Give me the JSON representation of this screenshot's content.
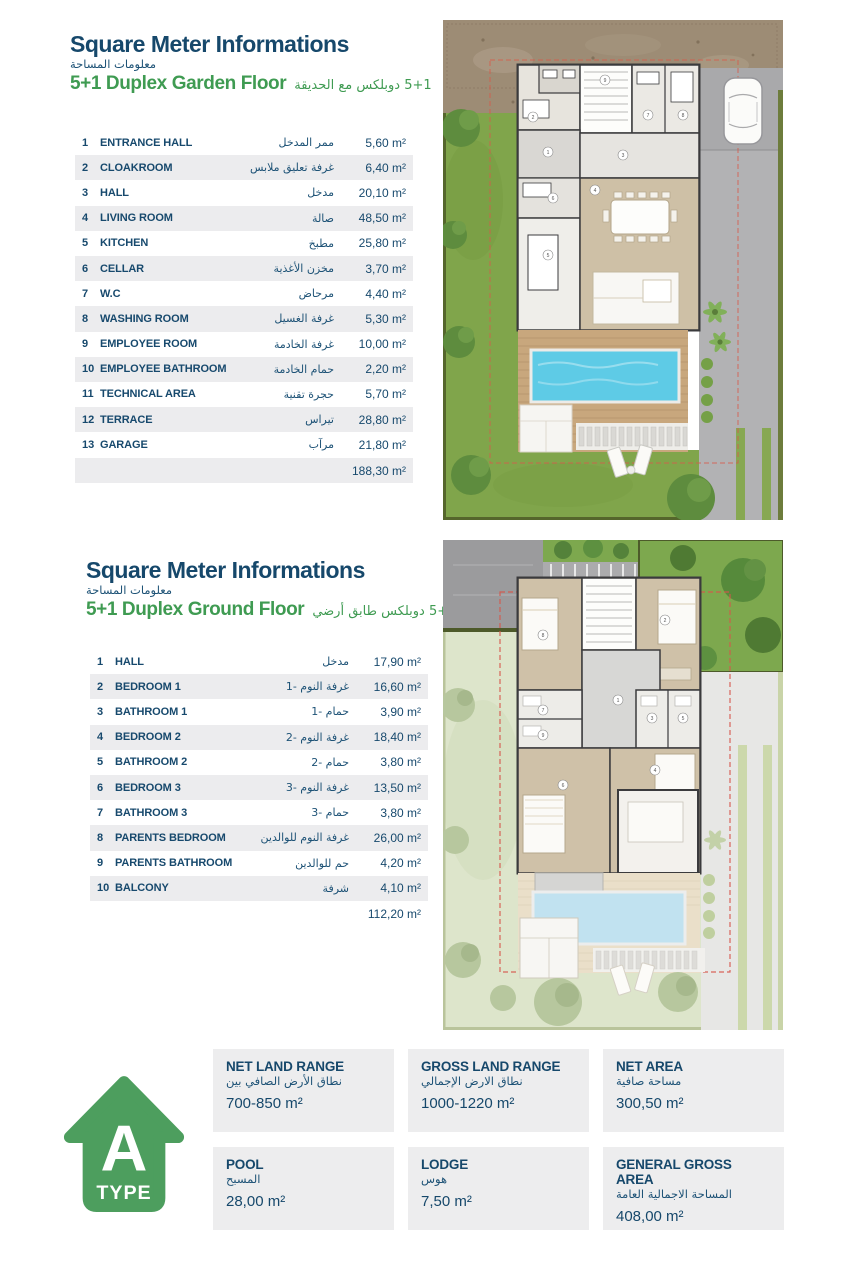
{
  "colors": {
    "navy": "#16486b",
    "green": "#3f9b52",
    "row_alt": "#ececee",
    "icon_green": "#4d9e5e",
    "pool_blue": "#5ecbe6",
    "lawn_green": "#80a54b"
  },
  "section1": {
    "title": "Square Meter Informations",
    "title_ar": "معلومات المساحة",
    "subtitle": "5+1 Duplex Garden Floor",
    "subtitle_ar": "5+1 دوبلكس مع الحديقة",
    "rows": [
      {
        "num": "1",
        "name": "ENTRANCE HALL",
        "ar": "ممر المدخل",
        "value": "5,60 m²"
      },
      {
        "num": "2",
        "name": "CLOAKROOM",
        "ar": "غرفة تعليق ملابس",
        "value": "6,40 m²"
      },
      {
        "num": "3",
        "name": "HALL",
        "ar": "مدخل",
        "value": "20,10 m²"
      },
      {
        "num": "4",
        "name": "LIVING ROOM",
        "ar": "صالة",
        "value": "48,50 m²"
      },
      {
        "num": "5",
        "name": "KITCHEN",
        "ar": "مطبخ",
        "value": "25,80 m²"
      },
      {
        "num": "6",
        "name": "CELLAR",
        "ar": "مخزن الأغذية",
        "value": "3,70 m²"
      },
      {
        "num": "7",
        "name": "W.C",
        "ar": "مرحاض",
        "value": "4,40 m²"
      },
      {
        "num": "8",
        "name": "WASHING ROOM",
        "ar": "غرفة الغسيل",
        "value": "5,30 m²"
      },
      {
        "num": "9",
        "name": "EMPLOYEE ROOM",
        "ar": "غرفة الخادمة",
        "value": "10,00 m²"
      },
      {
        "num": "10",
        "name": "EMPLOYEE BATHROOM",
        "ar": "حمام الخادمة",
        "value": "2,20 m²"
      },
      {
        "num": "11",
        "name": "TECHNICAL AREA",
        "ar": "حجرة تقنية",
        "value": "5,70 m²"
      },
      {
        "num": "12",
        "name": "TERRACE",
        "ar": "تيراس",
        "value": "28,80 m²"
      },
      {
        "num": "13",
        "name": "GARAGE",
        "ar": "مرآب",
        "value": "21,80 m²"
      }
    ],
    "total": "188,30 m²"
  },
  "section2": {
    "title": "Square Meter Informations",
    "title_ar": "معلومات المساحة",
    "subtitle": "5+1 Duplex Ground Floor",
    "subtitle_ar": "5+1 دوبلكس طابق أرضي",
    "rows": [
      {
        "num": "1",
        "name": "HALL",
        "ar": "مدخل",
        "value": "17,90 m²"
      },
      {
        "num": "2",
        "name": "BEDROOM 1",
        "ar": "غرفة النوم -1",
        "value": "16,60 m²"
      },
      {
        "num": "3",
        "name": "BATHROOM 1",
        "ar": "حمام -1",
        "value": "3,90 m²"
      },
      {
        "num": "4",
        "name": "BEDROOM 2",
        "ar": "غرفة النوم -2",
        "value": "18,40 m²"
      },
      {
        "num": "5",
        "name": "BATHROOM 2",
        "ar": "حمام -2",
        "value": "3,80 m²"
      },
      {
        "num": "6",
        "name": "BEDROOM 3",
        "ar": "غرفة النوم -3",
        "value": "13,50 m²"
      },
      {
        "num": "7",
        "name": "BATHROOM 3",
        "ar": "حمام -3",
        "value": "3,80 m²"
      },
      {
        "num": "8",
        "name": "PARENTS BEDROOM",
        "ar": "غرفة النوم للوالدين",
        "value": "26,00 m²"
      },
      {
        "num": "9",
        "name": "PARENTS BATHROOM",
        "ar": "حم للوالدين",
        "value": "4,20 m²"
      },
      {
        "num": "10",
        "name": "BALCONY",
        "ar": "شرفة",
        "value": "4,10 m²"
      }
    ],
    "total": "112,20 m²"
  },
  "type_badge": {
    "letter": "A",
    "word": "TYPE"
  },
  "summary": {
    "boxes": [
      {
        "title": "NET LAND RANGE",
        "ar": "نطاق الأرض الصافي بين",
        "value": "700-850 m²"
      },
      {
        "title": "GROSS LAND RANGE",
        "ar": "نطاق الارض الإجمالي",
        "value": "1000-1220 m²"
      },
      {
        "title": "NET AREA",
        "ar": "مساحة صافية",
        "value": "300,50 m²"
      },
      {
        "title": "POOL",
        "ar": "المسبح",
        "value": "28,00 m²"
      },
      {
        "title": "LODGE",
        "ar": "هوس",
        "value": "7,50 m²"
      },
      {
        "title": "GENERAL GROSS AREA",
        "ar": "المساحة الاجمالية العامة",
        "value": "408,00 m²"
      }
    ]
  }
}
